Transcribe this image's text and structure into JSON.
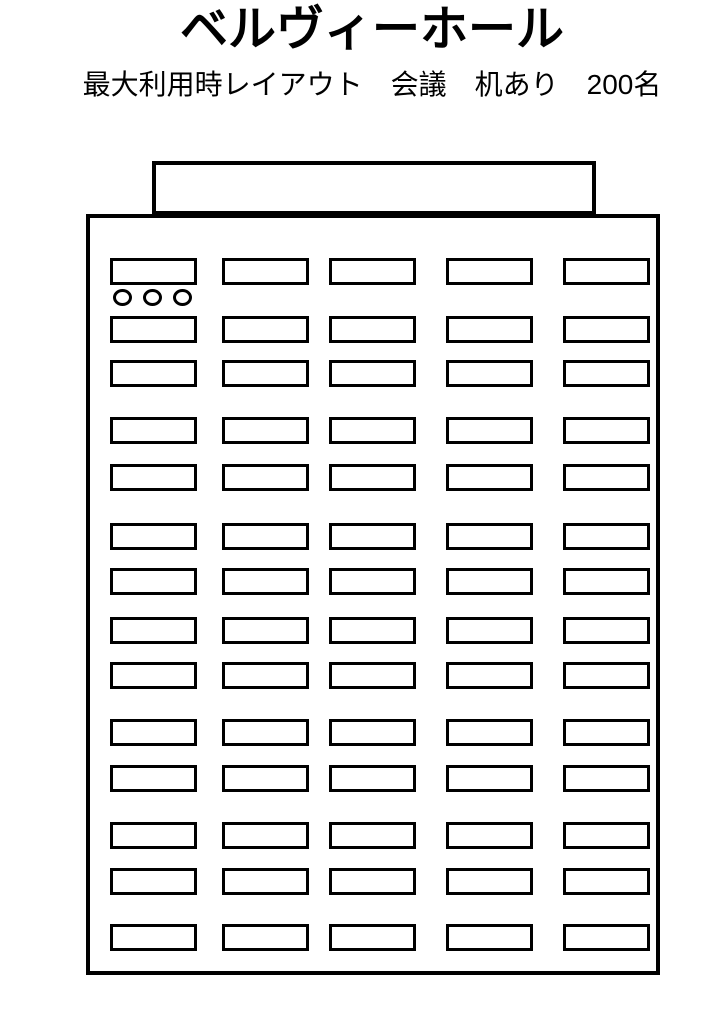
{
  "header": {
    "title": "ベルヴィーホール",
    "subtitle": "最大利用時レイアウト　会議　机あり　200名"
  },
  "hall": {
    "desk_rows": 14,
    "desk_columns": 5,
    "desk_count": 70,
    "head_desk_chairs": 3
  },
  "colors": {
    "line": "#000000",
    "background": "#ffffff"
  }
}
